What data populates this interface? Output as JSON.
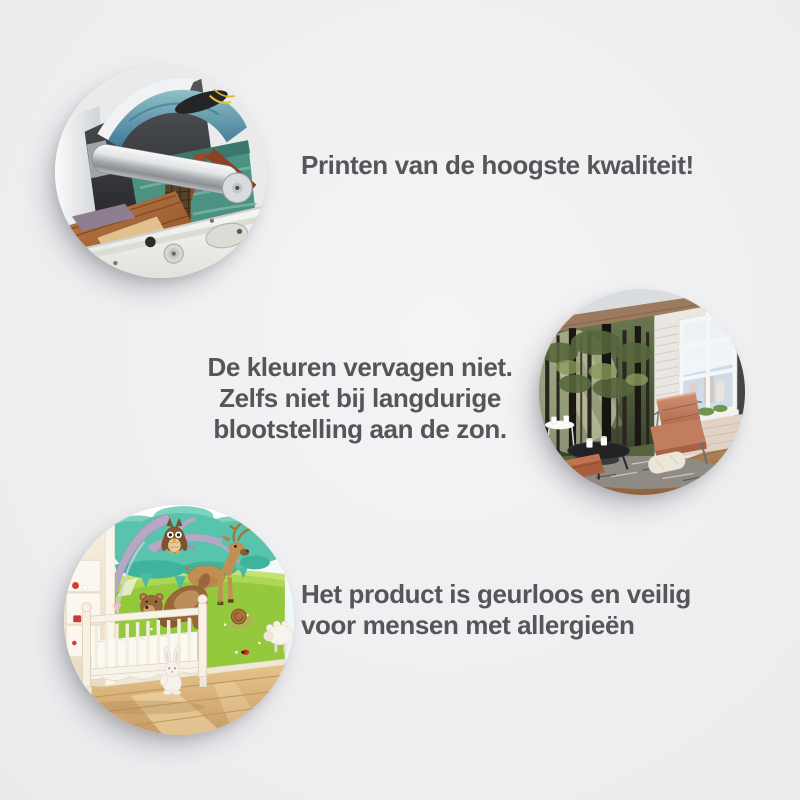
{
  "page": {
    "background": "#efeff1",
    "text_color": "#56565a"
  },
  "sections": [
    {
      "id": "print-quality",
      "photo_alt": "large-format printer printing a colorful canvas with a seascape and wooden pier artwork",
      "lines": [
        "Printen van de hoogste kwaliteit!"
      ]
    },
    {
      "id": "color-fastness",
      "photo_alt": "sunlit living room with forest photo wall mural, brick wall, window and leather armchair",
      "lines": [
        "De kleuren vervagen niet.",
        "Zelfs niet bij langdurige",
        "blootstelling aan de zon."
      ]
    },
    {
      "id": "allergy-safe",
      "photo_alt": "nursery with cartoon forest animal wall mural, white crib and plush bunny",
      "lines": [
        "Het product is geurloos en veilig",
        "voor mensen met allergieën"
      ]
    }
  ]
}
